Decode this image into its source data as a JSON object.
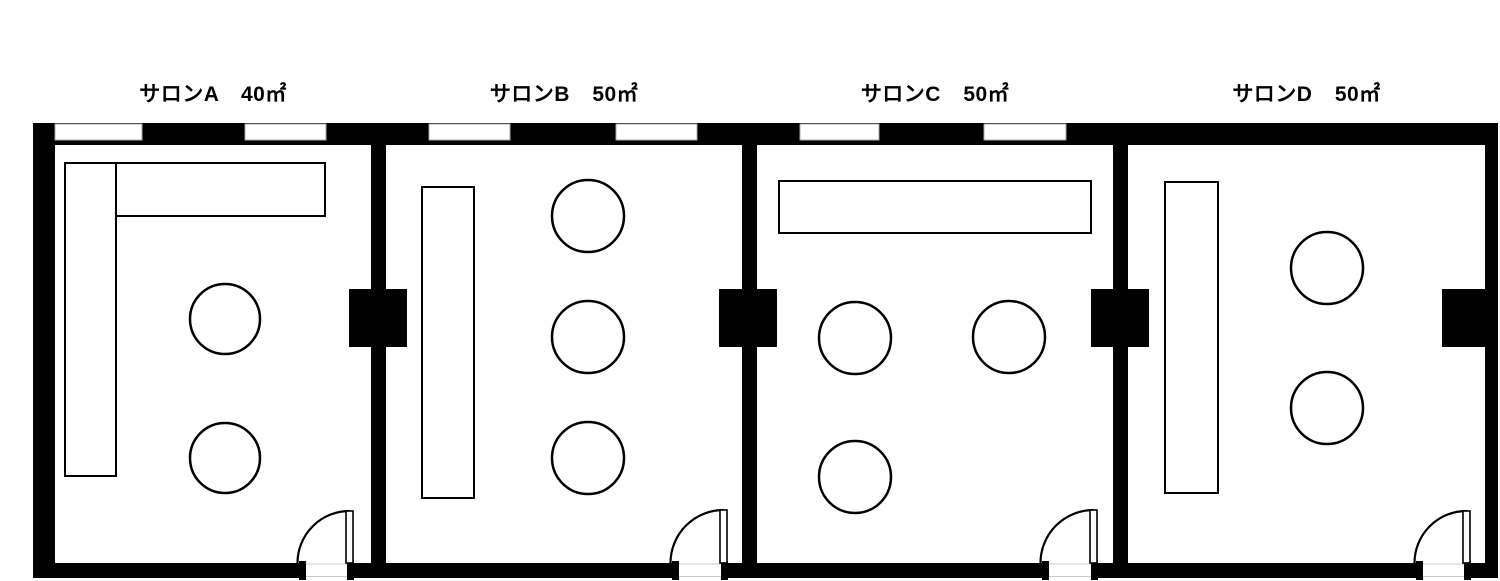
{
  "plan": {
    "bg": "#ffffff",
    "wall_color": "#000000",
    "window_stroke": "#a8a8a8",
    "furniture_stroke": "#000000",
    "door_floor_line": "#c8c8c8",
    "outer": {
      "x": 33,
      "y": 123,
      "right": 1498,
      "bottom": 578,
      "left_t": 22,
      "top_t": 22,
      "right_t": 13,
      "bottom_t": 15
    },
    "dividers": [
      {
        "x": 371,
        "w": 15
      },
      {
        "x": 742,
        "w": 15
      },
      {
        "x": 1113,
        "w": 15
      }
    ],
    "windows_y": 124,
    "windows_h": 16,
    "windows": [
      {
        "x": 55,
        "w": 87
      },
      {
        "x": 245,
        "w": 81
      },
      {
        "x": 429,
        "w": 81
      },
      {
        "x": 616,
        "w": 81
      },
      {
        "x": 800,
        "w": 79
      },
      {
        "x": 984,
        "w": 82
      }
    ],
    "connector_y": 289,
    "connector_h": 58,
    "connectors": [
      {
        "x": 349,
        "w": 58
      },
      {
        "x": 719,
        "w": 58
      },
      {
        "x": 1091,
        "w": 58
      },
      {
        "x": 1442,
        "w": 43
      }
    ],
    "rooms": [
      {
        "name": "サロンA",
        "area": "40㎡",
        "x": 55,
        "w": 316,
        "rects": [
          [
            65,
            163,
            51,
            313
          ],
          [
            116,
            163,
            209,
            53
          ]
        ],
        "circles": [
          [
            225,
            319,
            35
          ],
          [
            225,
            458,
            35
          ]
        ],
        "door": {
          "x1": 300,
          "x2": 353
        }
      },
      {
        "name": "サロンB",
        "area": "50㎡",
        "x": 386,
        "w": 356,
        "rects": [
          [
            422,
            187,
            52,
            311
          ]
        ],
        "circles": [
          [
            588,
            216,
            36
          ],
          [
            588,
            337,
            36
          ],
          [
            588,
            458,
            36
          ]
        ],
        "door": {
          "x1": 673,
          "x2": 727
        }
      },
      {
        "name": "サロンC",
        "area": "50㎡",
        "x": 757,
        "w": 356,
        "rects": [
          [
            779,
            181,
            312,
            52
          ]
        ],
        "circles": [
          [
            855,
            338,
            36
          ],
          [
            1009,
            337,
            36
          ],
          [
            855,
            477,
            36
          ]
        ],
        "door": {
          "x1": 1043,
          "x2": 1097
        }
      },
      {
        "name": "サロンD",
        "area": "50㎡",
        "x": 1128,
        "w": 357,
        "rects": [
          [
            1165,
            182,
            53,
            311
          ]
        ],
        "circles": [
          [
            1327,
            268,
            36
          ],
          [
            1327,
            408,
            36
          ]
        ],
        "door": {
          "x1": 1417,
          "x2": 1470
        }
      }
    ]
  }
}
